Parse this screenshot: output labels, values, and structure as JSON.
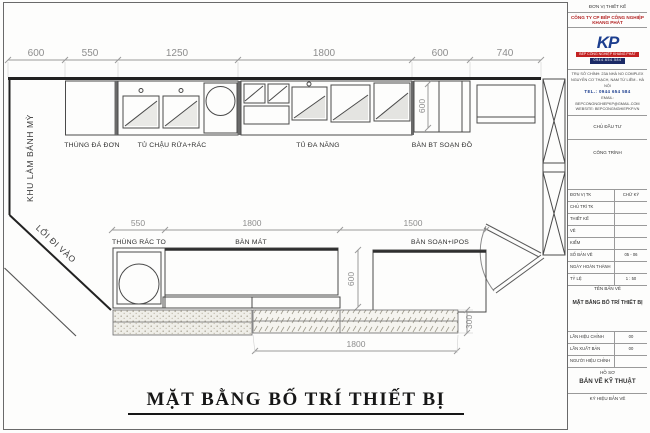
{
  "sheet_title": "MẶT BẰNG BỐ TRÍ THIẾT BỊ",
  "plan": {
    "dims_top": [
      "600",
      "550",
      "1250",
      "1800",
      "600",
      "740"
    ],
    "dims_mid": [
      "550",
      "1800",
      "1500"
    ],
    "dim_bottom": "1800",
    "dim_depth_top": "600",
    "dim_depth_mid": "600",
    "dim_strip": "300",
    "labels_top": [
      "THÙNG ĐÁ ĐƠN",
      "TỦ CHẬU RỬA+RÁC",
      "TỦ ĐA NĂNG",
      "BÀN BT SOẠN ĐỒ"
    ],
    "labels_mid": [
      "THÙNG RÁC TO",
      "BÀN MÁT",
      "BÀN SOẠN+IPOS"
    ],
    "area_left": "KHU LÀM BÁNH MỲ",
    "area_walkway": "LỐI ĐI VÀO"
  },
  "titleblock": {
    "header": "ĐƠN VỊ THIẾT KẾ",
    "company": "CÔNG TY CP BẾP CÔNG NGHIỆP KHANG PHÁT",
    "logo": {
      "mark": "KP",
      "bar1": "BẾP CÔNG NGHIỆP KHANG PHÁT",
      "bar2": "0944.654.584"
    },
    "contact": {
      "address1": "TRỤ SỞ CHÍNH: 23A NHÀ NO COMPLEX",
      "address2": "NGUYỄN CƠ THẠCH, NAM TỪ LIÊM - HÀ NỘI",
      "tel": "TEL.: 0944 654 584",
      "email": "EMAIL: BEPCONGNGHIEPKP@GMAIL.COM",
      "website": "WEBSITE: BEPCONGNGHIEPKP.VN"
    },
    "client_label": "CHỦ ĐẦU TƯ",
    "project_label": "CÔNG TRÌNH",
    "rows": [
      {
        "label": "ĐƠN VỊ TK",
        "value": "CHỮ KÝ"
      },
      {
        "label": "CHỦ TRÌ TK",
        "value": ""
      },
      {
        "label": "THIẾT KẾ",
        "value": ""
      },
      {
        "label": "VẼ",
        "value": ""
      },
      {
        "label": "KIỂM",
        "value": ""
      },
      {
        "label": "SỐ BẢN VẼ",
        "value": "05 - 06"
      },
      {
        "label": "NGÀY HOÀN THÀNH",
        "value": ""
      },
      {
        "label": "TỶ LỆ",
        "value": "1 : 50"
      }
    ],
    "drawing_name_label": "TÊN BẢN VẼ",
    "drawing_name": "MẶT BẰNG BỐ TRÍ THIẾT BỊ",
    "rows2": [
      {
        "label": "LẦN HIỆU CHỈNH",
        "value": "00"
      },
      {
        "label": "LẦN XUẤT BẢN",
        "value": "00"
      },
      {
        "label": "NGƯỜI HIỆU CHỈNH",
        "value": ""
      }
    ],
    "dossier_label": "HỒ SƠ",
    "dossier": "BẢN VẼ KỸ THUẬT",
    "code_label": "KÝ HIỆU BẢN VẼ"
  }
}
